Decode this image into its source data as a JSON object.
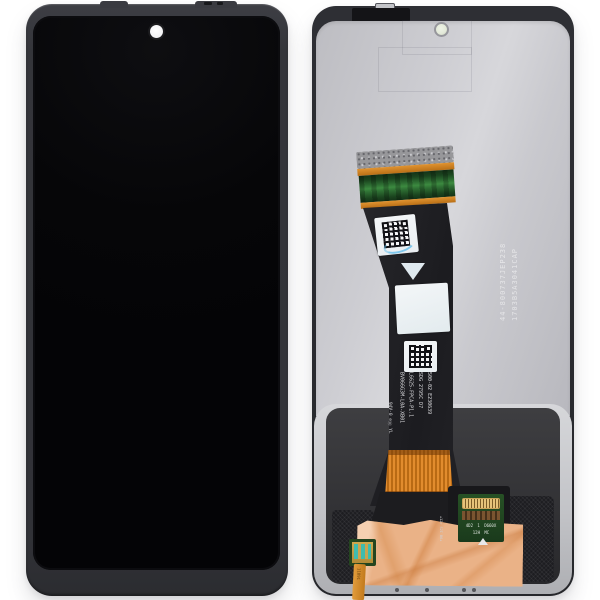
{
  "scene": {
    "type": "product-photo",
    "subject": "Smartphone LCD display assembly replacement part, front view and back view side by side",
    "background_color": "#ffffff"
  },
  "front_view": {
    "description": "Front of display: black screen, slim dark bezel, centered punch-hole camera cutout"
  },
  "back_view": {
    "etched_serials": [
      "44-800737JEP238",
      "1703B5A3041CAP"
    ],
    "flex_label_lines": [
      "BV066G3M-L0A-XB01",
      "L6625-FPCA-P1.1",
      "SDG 2795C D7",
      "500-02 E230639"
    ],
    "flex_cert_marks": "94V-0 ⊖Ⓤ YL",
    "connector_pcb_text": "4D2 1 D660X 12H MC",
    "tail_text": "11891",
    "colors": {
      "frame": "#36373c",
      "metal_plate": "#cbcbd0",
      "flex_black": "#1f1f23",
      "flex_orange": "#d9882a",
      "copper_tape": "#eab287",
      "pcb_green": "#1d4a22",
      "connector_teal": "#3fbcae",
      "connector_gold": "#caa35a"
    }
  }
}
